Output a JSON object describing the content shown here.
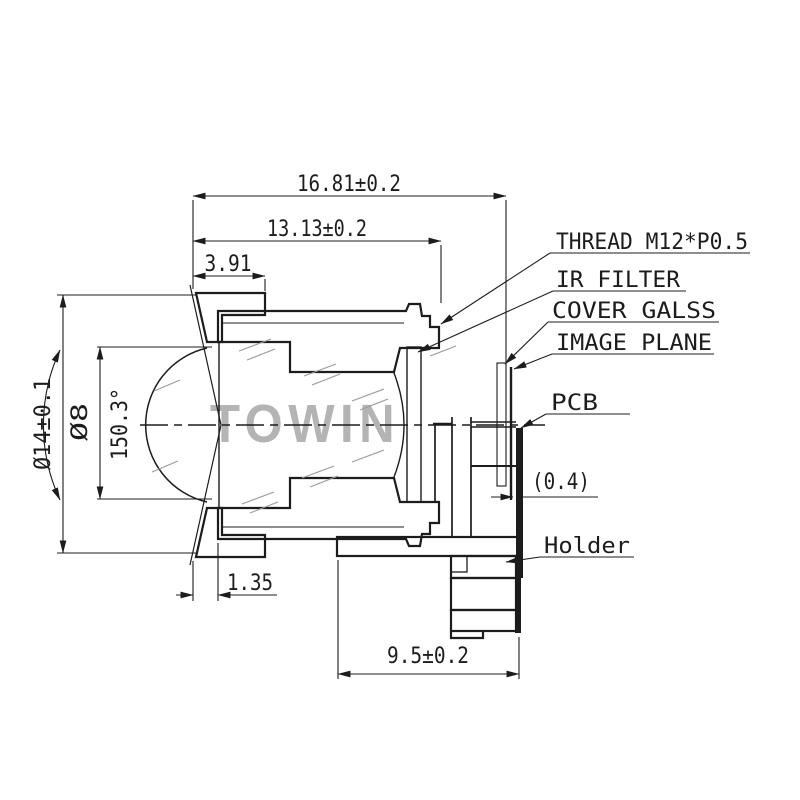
{
  "drawing": {
    "watermark": "TOWIN",
    "dims": {
      "total_length": "16.81±0.2",
      "thread_length": "13.13±0.2",
      "front_length": "3.91",
      "outer_dia": "Ø14±0.1",
      "front_lens_dia": "Ø8",
      "fov": "150.3°",
      "front_step": "1.35",
      "glass_gap": "(0.4)",
      "holder_length": "9.5±0.2"
    },
    "labels": {
      "thread": "THREAD M12*P0.5",
      "ir_filter": "IR FILTER",
      "cover_glass": "COVER GALSS",
      "image_plane": "IMAGE PLANE",
      "pcb": "PCB",
      "holder": "Holder"
    },
    "colors": {
      "line": "#1c1c1c",
      "watermark": "#b4b4b4",
      "background": "#ffffff"
    }
  }
}
